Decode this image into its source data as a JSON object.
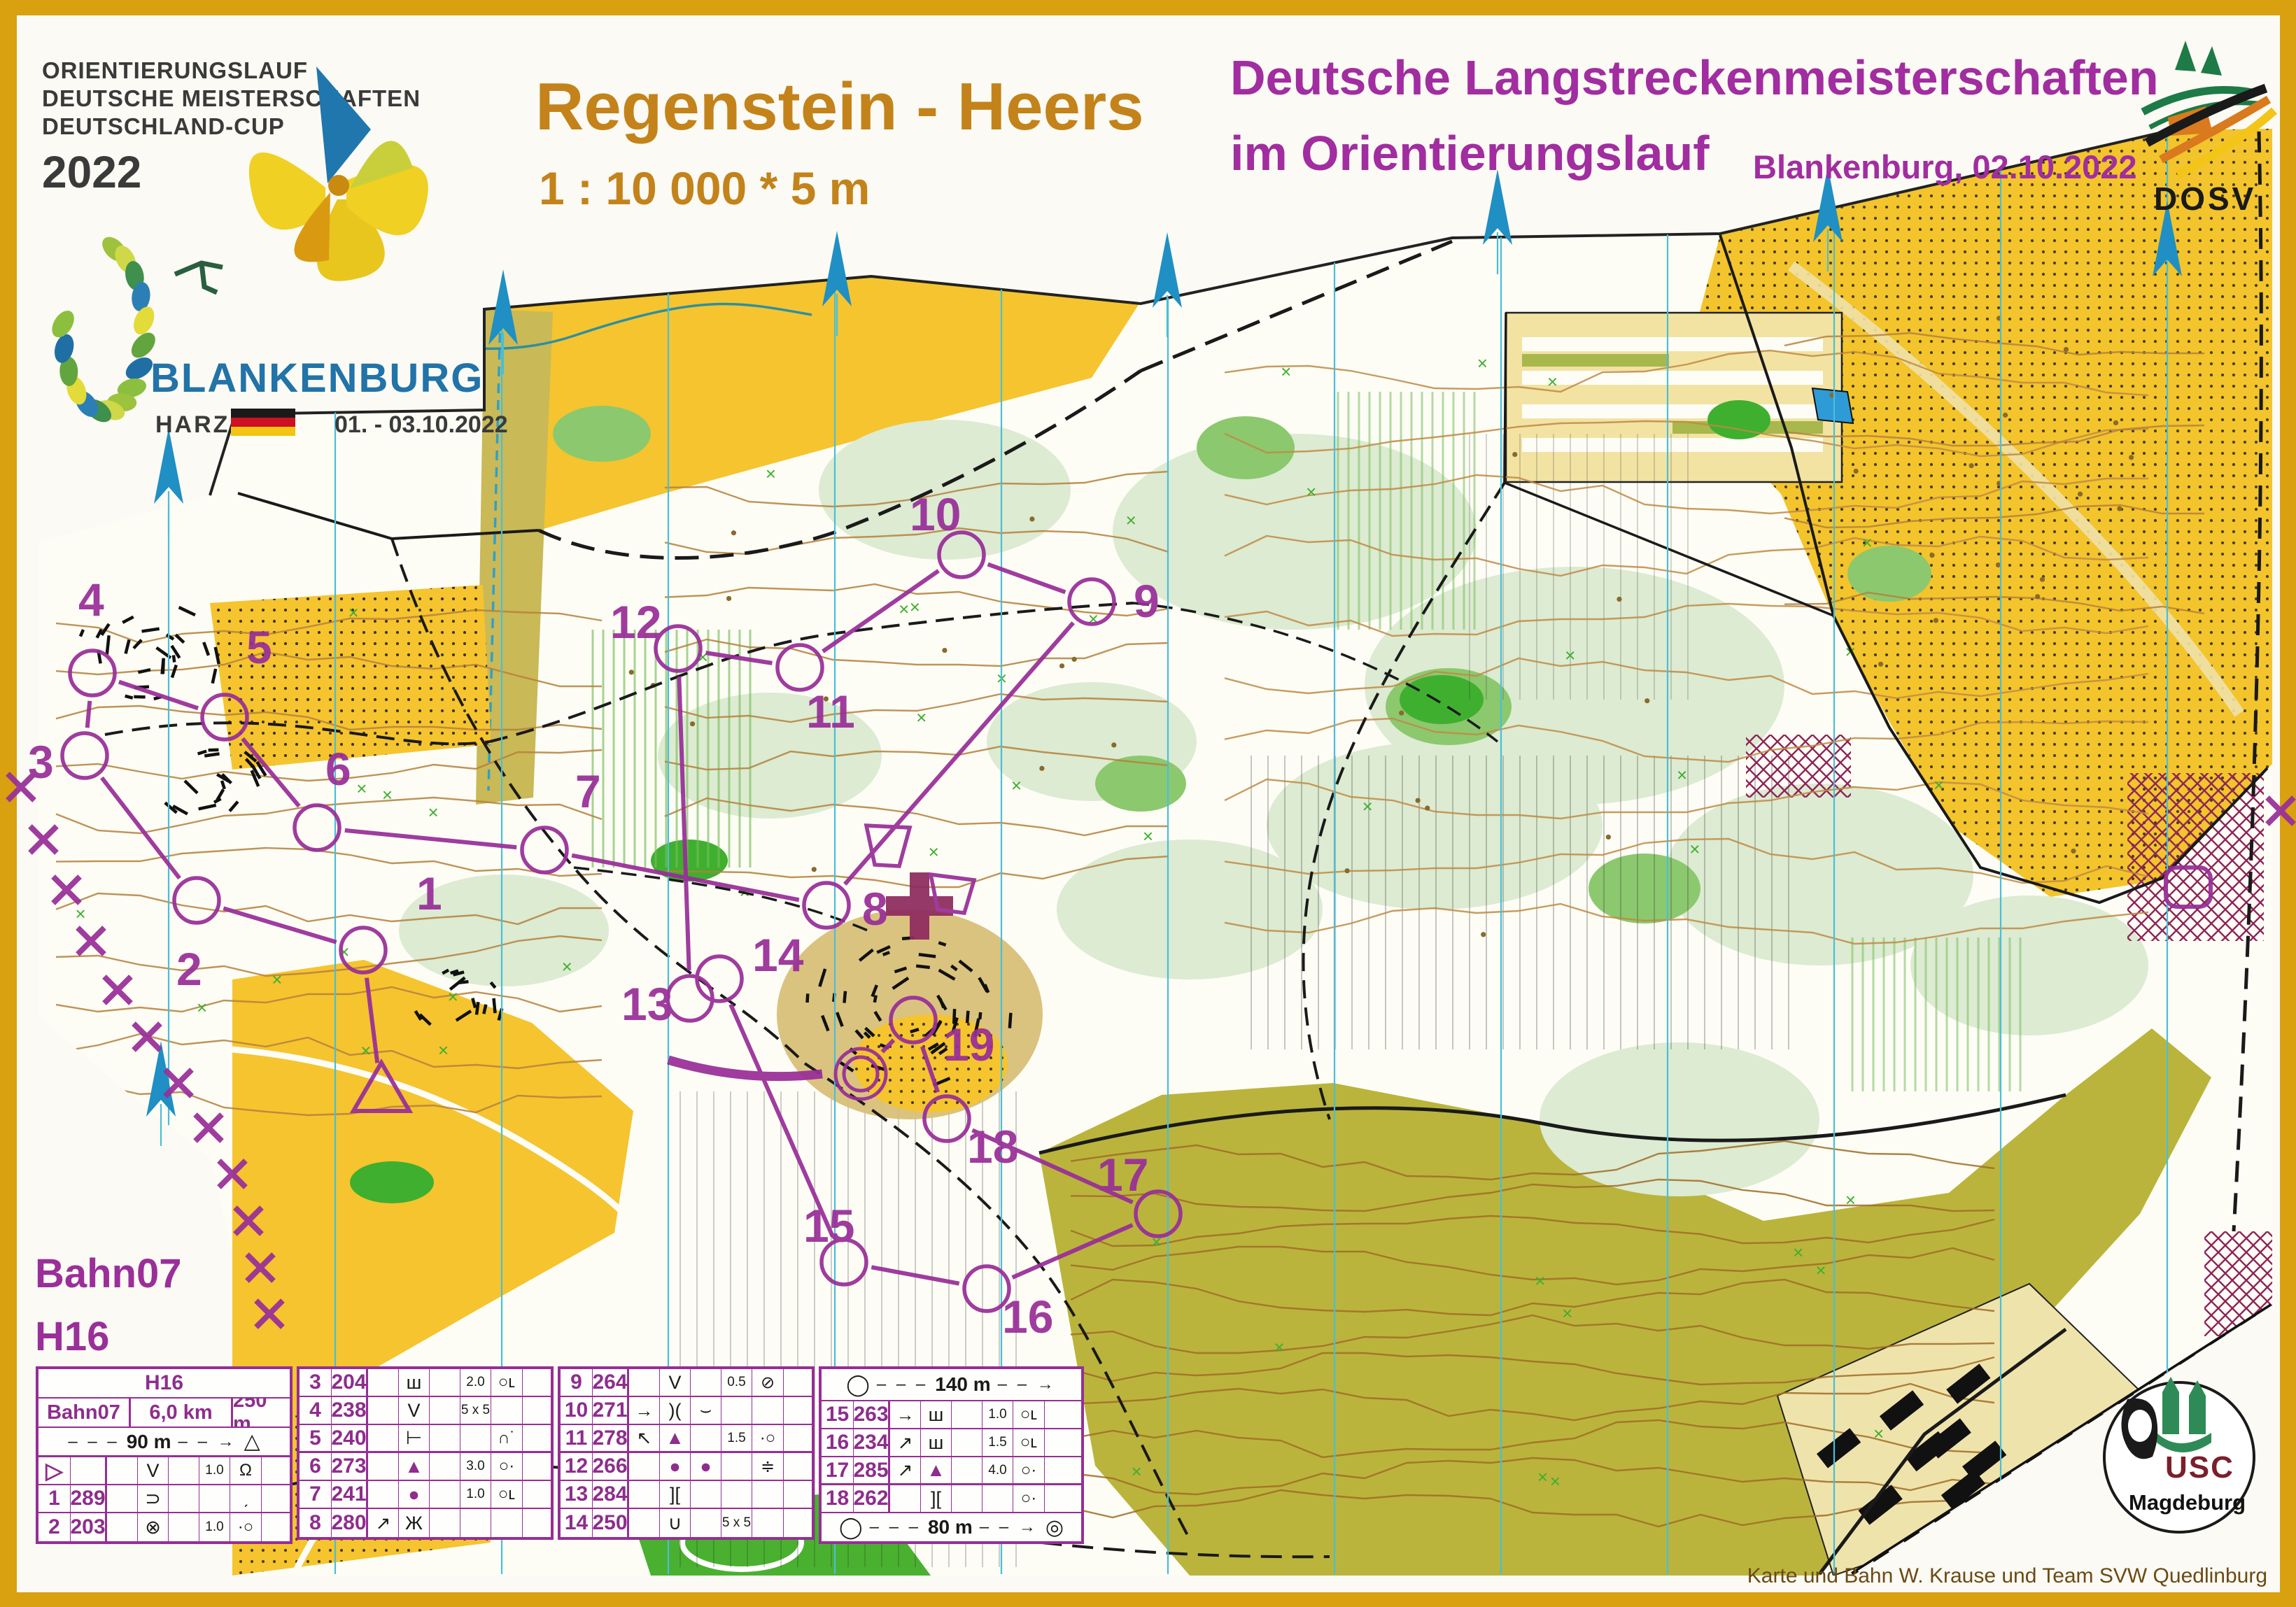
{
  "header": {
    "series": [
      "ORIENTIERUNGSLAUF",
      "DEUTSCHE MEISTERSCHAFTEN",
      "DEUTSCHLAND-CUP"
    ],
    "year": "2022",
    "title": "Regenstein - Heers",
    "scale_line": "1 : 10 000  *  5 m",
    "champ_line1": "Deutsche Langstreckenmeisterschaften",
    "champ_line2": "im Orientierungslauf",
    "venue_date": "Blankenburg,  02.10.2022",
    "federation_acronym": "DOSV"
  },
  "host": {
    "city": "BLANKENBURG",
    "region": "HARZ",
    "dates": "01. - 03.10.2022"
  },
  "course_labels": {
    "course": "Bahn07",
    "class": "H16"
  },
  "credit": "Karte und Bahn W. Krause und Team SVW Quedlinburg",
  "club": {
    "name": "USC",
    "city": "Magdeburg"
  },
  "control_card": {
    "class_header": "H16",
    "info_row": [
      "Bahn07",
      "6,0 km",
      "250 m"
    ],
    "start_distance": "90 m",
    "exchange_distance": "140 m",
    "finish_distance": "80 m",
    "sections": [
      {
        "rows": [
          [
            "▷",
            "",
            "",
            "V",
            "",
            "1.0",
            "Ω",
            ""
          ],
          [
            "1",
            "289",
            "",
            "⊃",
            "",
            "",
            "ˏ",
            ""
          ],
          [
            "2",
            "203",
            "",
            "⊗",
            "",
            "1.0",
            "·○",
            ""
          ]
        ]
      },
      {
        "rows": [
          [
            "3",
            "204",
            "",
            "ш",
            "",
            "2.0",
            "○ʟ",
            ""
          ],
          [
            "4",
            "238",
            "",
            "V",
            "",
            "5 x 5",
            "",
            ""
          ],
          [
            "5",
            "240",
            "",
            "⊢",
            "",
            "",
            "∩˙",
            ""
          ],
          [
            "6",
            "273",
            "",
            "▲",
            "",
            "3.0",
            "○·",
            ""
          ],
          [
            "7",
            "241",
            "",
            "●",
            "",
            "1.0",
            "○ʟ",
            ""
          ],
          [
            "8",
            "280",
            "↗",
            "Ж",
            "",
            "",
            "",
            ""
          ]
        ]
      },
      {
        "rows": [
          [
            "9",
            "264",
            "",
            "V",
            "",
            "0.5",
            "⊘",
            ""
          ],
          [
            "10",
            "271",
            "→",
            ")(",
            "⌣",
            "",
            "",
            ""
          ],
          [
            "11",
            "278",
            "↖",
            "▲",
            "",
            "1.5",
            "·○",
            ""
          ],
          [
            "12",
            "266",
            "",
            "●",
            "●",
            "",
            "≑",
            ""
          ],
          [
            "13",
            "284",
            "",
            "][",
            "",
            "",
            "",
            ""
          ],
          [
            "14",
            "250",
            "",
            "∪",
            "",
            "5 x 5",
            "",
            ""
          ]
        ]
      },
      {
        "rows": [
          [
            "15",
            "263",
            "→",
            "ш",
            "",
            "1.0",
            "○ʟ",
            ""
          ],
          [
            "16",
            "234",
            "↗",
            "ш",
            "",
            "1.5",
            "○ʟ",
            ""
          ],
          [
            "17",
            "285",
            "↗",
            "▲",
            "",
            "4.0",
            "○·",
            ""
          ],
          [
            "18",
            "262",
            "",
            "][",
            "",
            "",
            "○·",
            ""
          ],
          [
            "19",
            "299",
            "",
            "ш",
            "",
            "1.5",
            "○ʟ",
            ""
          ]
        ]
      }
    ]
  },
  "course": {
    "start": {
      "x": 545,
      "y": 1565
    },
    "finish": {
      "x": 1230,
      "y": 1535
    },
    "controls": [
      {
        "n": "1",
        "x": 519,
        "y": 1358,
        "lx": 595,
        "ly": 1300
      },
      {
        "n": "2",
        "x": 281,
        "y": 1287,
        "lx": 252,
        "ly": 1408
      },
      {
        "n": "3",
        "x": 121,
        "y": 1080,
        "lx": 40,
        "ly": 1112
      },
      {
        "n": "4",
        "x": 132,
        "y": 962,
        "lx": 112,
        "ly": 880
      },
      {
        "n": "5",
        "x": 321,
        "y": 1025,
        "lx": 352,
        "ly": 948
      },
      {
        "n": "6",
        "x": 453,
        "y": 1183,
        "lx": 465,
        "ly": 1122
      },
      {
        "n": "7",
        "x": 778,
        "y": 1215,
        "lx": 822,
        "ly": 1154
      },
      {
        "n": "8",
        "x": 1181,
        "y": 1294,
        "lx": 1232,
        "ly": 1322
      },
      {
        "n": "9",
        "x": 1560,
        "y": 860,
        "lx": 1620,
        "ly": 882
      },
      {
        "n": "10",
        "x": 1374,
        "y": 793,
        "lx": 1300,
        "ly": 758
      },
      {
        "n": "11",
        "x": 1143,
        "y": 954,
        "lx": 1152,
        "ly": 1040
      },
      {
        "n": "12",
        "x": 969,
        "y": 927,
        "lx": 872,
        "ly": 912
      },
      {
        "n": "13",
        "x": 986,
        "y": 1427,
        "lx": 888,
        "ly": 1458
      },
      {
        "n": "14",
        "x": 1028,
        "y": 1399,
        "lx": 1075,
        "ly": 1388
      },
      {
        "n": "15",
        "x": 1206,
        "y": 1804,
        "lx": 1148,
        "ly": 1775
      },
      {
        "n": "16",
        "x": 1410,
        "y": 1842,
        "lx": 1432,
        "ly": 1905
      },
      {
        "n": "17",
        "x": 1655,
        "y": 1735,
        "lx": 1568,
        "ly": 1702
      },
      {
        "n": "18",
        "x": 1353,
        "y": 1599,
        "lx": 1382,
        "ly": 1662
      },
      {
        "n": "19",
        "x": 1305,
        "y": 1458,
        "lx": 1348,
        "ly": 1516
      }
    ]
  },
  "map_symbols": {
    "medical_cross": {
      "x": 1314,
      "y": 1295
    }
  }
}
